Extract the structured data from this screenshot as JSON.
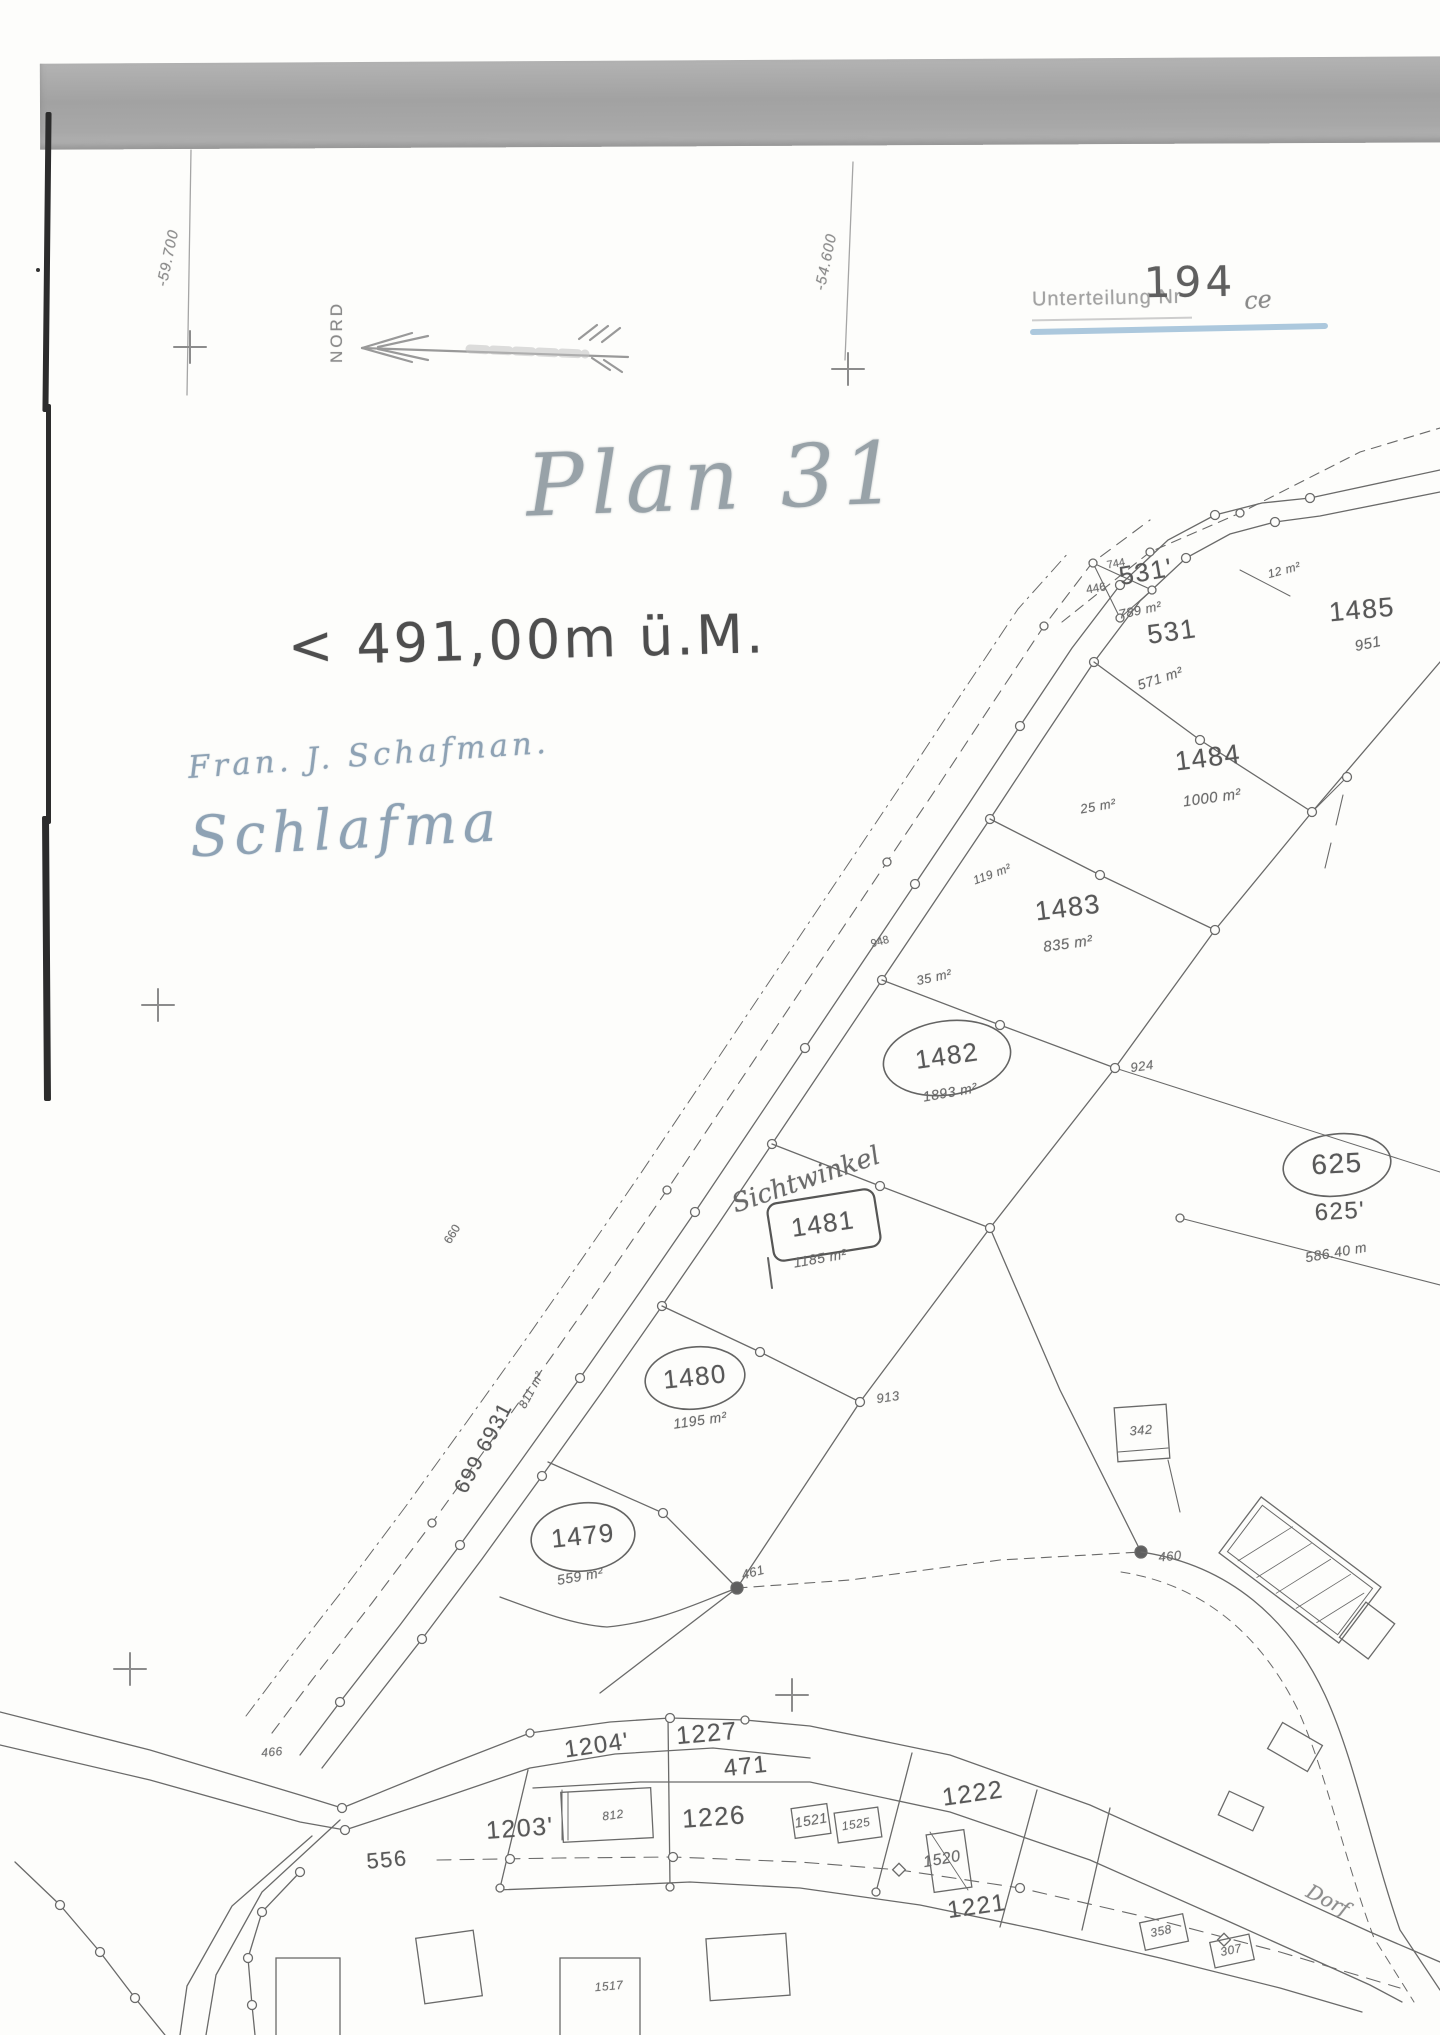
{
  "document": {
    "stamp": {
      "label": "Unterteilung Nr",
      "number": "194",
      "suffix": "ce"
    },
    "grid": {
      "left_coordinate": "-59.700",
      "right_coordinate": "-54.600"
    },
    "north_label": "NORD",
    "title": "Plan 31",
    "elevation_note": "< 491,00m ü.M.",
    "handwriting": {
      "line1": "Fran. J. Schafman.",
      "signature": "Schlafma"
    }
  },
  "map": {
    "street": {
      "number": "699 6931",
      "area": "811 m²"
    },
    "annotations": {
      "view_angle": "Sichtwinkel",
      "distance": "586.40 m",
      "road_name": "Dorf"
    },
    "parcels": [
      {
        "number": "531'",
        "area": "789 m²"
      },
      {
        "number": "531",
        "area": "571 m²"
      },
      {
        "number": "1485",
        "area": "951"
      },
      {
        "number": "1484",
        "area": "1000 m²"
      },
      {
        "number": "1483",
        "area": "835 m²"
      },
      {
        "number": "1482",
        "area": "1893 m²"
      },
      {
        "number": "1481",
        "area": "1185 m²"
      },
      {
        "number": "1480",
        "area": "1195 m²"
      },
      {
        "number": "1479",
        "area": "559 m²"
      },
      {
        "number": "625"
      },
      {
        "number": "625'"
      },
      {
        "number": "1204'"
      },
      {
        "number": "1227"
      },
      {
        "number": "471"
      },
      {
        "number": "1226"
      },
      {
        "number": "1203'"
      },
      {
        "number": "1222"
      },
      {
        "number": "1221"
      },
      {
        "number": "1520"
      },
      {
        "number": "1521"
      },
      {
        "number": "556"
      }
    ],
    "small_areas": {
      "a25": "25 m²",
      "a35": "35 m²",
      "a12": "12 m²",
      "a119": "119 m²"
    },
    "points": {
      "p446": "446",
      "p744": "744",
      "p948": "948",
      "p924": "924",
      "p913": "913",
      "p461": "461",
      "p460": "460",
      "p466": "466",
      "p660": "660"
    },
    "buildings": {
      "b342": "342",
      "b812": "812",
      "b358": "358",
      "b307": "307",
      "b1517": "1517",
      "b1525": "1525"
    }
  }
}
